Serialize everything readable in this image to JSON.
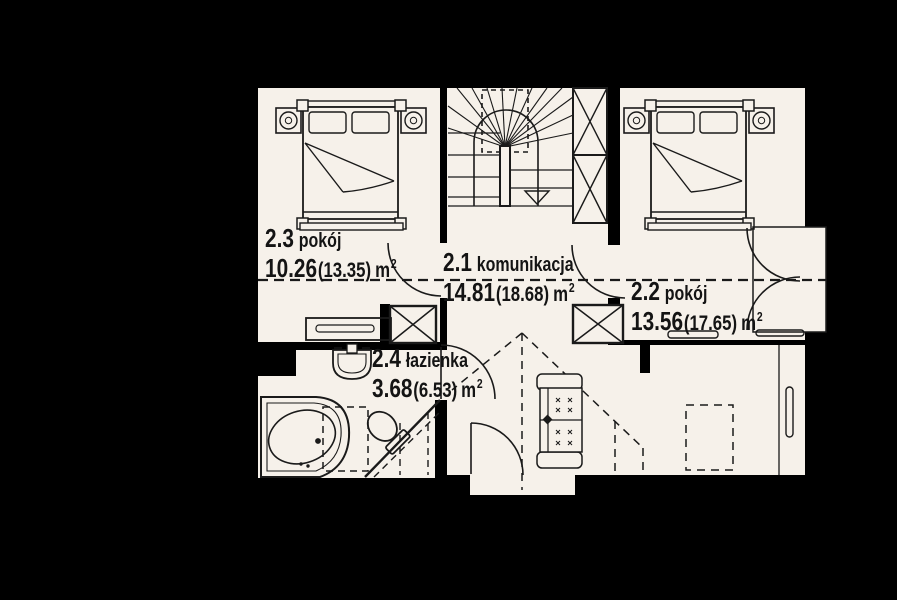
{
  "plan": {
    "unit": "m",
    "unit_sup": "2",
    "rooms": [
      {
        "id": "2.1",
        "name": "komunikacja",
        "area": "14.81",
        "area_alt": "(18.68)"
      },
      {
        "id": "2.2",
        "name": "pokój",
        "area": "13.56",
        "area_alt": "(17.65)"
      },
      {
        "id": "2.3",
        "name": "pokój",
        "area": "10.26",
        "area_alt": "(13.35)"
      },
      {
        "id": "2.4",
        "name": "łazienka",
        "area": "3.68",
        "area_alt": "(6.53)"
      }
    ],
    "colors": {
      "background": "#000000",
      "floor": "#f6f1ea",
      "line": "#1a1a1a"
    }
  }
}
